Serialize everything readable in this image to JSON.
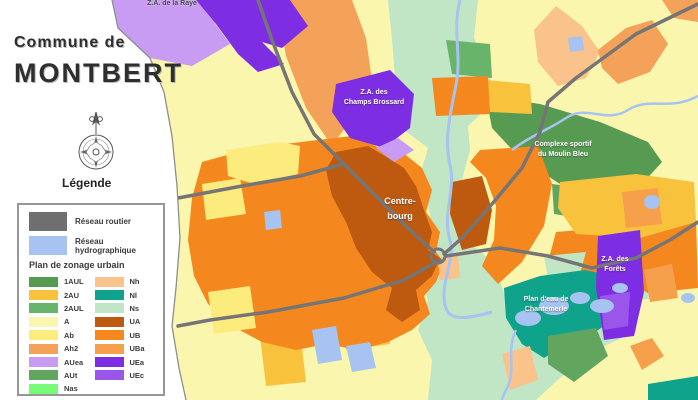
{
  "title": {
    "line1": "Commune de",
    "line2": "MONTBERT"
  },
  "legend": {
    "heading": "Légende",
    "network_items": [
      {
        "label": "Réseau routier",
        "color": "#6F6F6F"
      },
      {
        "label": "Réseau hydrographique",
        "color": "#A6C3F1"
      }
    ],
    "zoning_heading": "Plan de zonage urbain",
    "zones_left": [
      {
        "code": "1AUL",
        "color": "#579B52"
      },
      {
        "code": "2AU",
        "color": "#F8C23D"
      },
      {
        "code": "2AUL",
        "color": "#69B46B"
      },
      {
        "code": "A",
        "color": "#FBF6AE"
      },
      {
        "code": "Ab",
        "color": "#FCEC7E"
      },
      {
        "code": "Ah2",
        "color": "#F4A259"
      },
      {
        "code": "AUea",
        "color": "#C79CF2"
      },
      {
        "code": "AUt",
        "color": "#61A55F"
      },
      {
        "code": "Nas",
        "color": "#77FB79"
      }
    ],
    "zones_right": [
      {
        "code": "Nh",
        "color": "#F9C38B"
      },
      {
        "code": "Nl",
        "color": "#10A38B"
      },
      {
        "code": "Ns",
        "color": "#C1E6C5"
      },
      {
        "code": "UA",
        "color": "#BD5A10"
      },
      {
        "code": "UB",
        "color": "#F5871F"
      },
      {
        "code": "UBa",
        "color": "#F7A04C"
      },
      {
        "code": "UEa",
        "color": "#7D2DE2"
      },
      {
        "code": "UEc",
        "color": "#9A55EB"
      }
    ]
  },
  "colors": {
    "a": "#FBF6AE",
    "ab": "#FCEC7E",
    "ah2": "#F4A259",
    "auea": "#C79CF2",
    "aut": "#61A55F",
    "aul1": "#579B52",
    "au2": "#F8C23D",
    "aul2": "#69B46B",
    "nas": "#77FB79",
    "nh": "#F9C38B",
    "nl": "#10A38B",
    "ns": "#C1E6C5",
    "ua": "#BD5A10",
    "ub": "#F5871F",
    "uba": "#F7A04C",
    "uea": "#7D2DE2",
    "uec": "#9A55EB",
    "water": "#A6C3F1",
    "road": "#757575",
    "boundary": "#8E8E8E",
    "outside": "#FFFFFF"
  },
  "map_labels": {
    "raye": "Z.A. de la Raye",
    "brossard_l1": "Z.A. des",
    "brossard_l2": "Champs Brossard",
    "centre_l1": "Centre-",
    "centre_l2": "bourg",
    "moulin_l1": "Complexe sportif",
    "moulin_l2": "du Moulin Bleu",
    "forets_l1": "Z.A. des",
    "forets_l2": "Forêts",
    "chantemerle_l1": "Plan d'eau de",
    "chantemerle_l2": "Chantemerle"
  }
}
